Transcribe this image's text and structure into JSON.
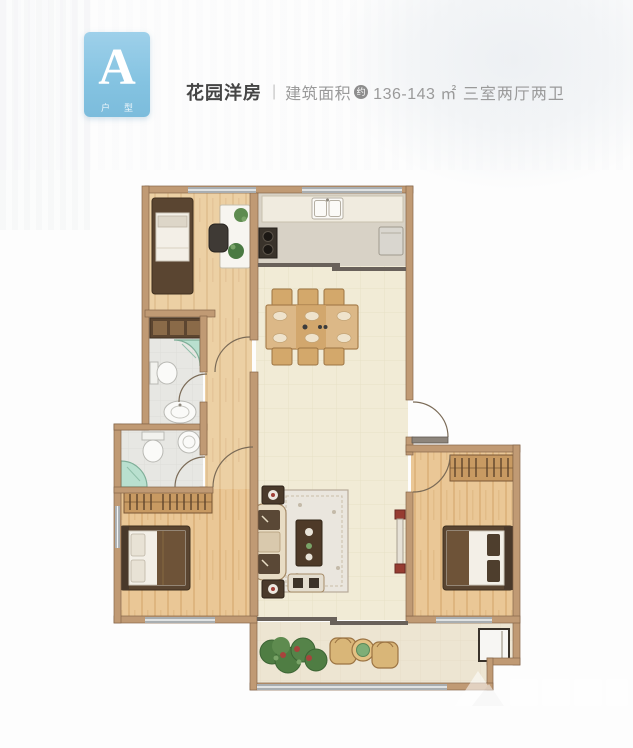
{
  "header": {
    "badge": {
      "letter": "A",
      "sublabel": "户型"
    },
    "title": "花园洋房",
    "divider": "|",
    "area_label": "建筑面积",
    "area_approx_badge": "约",
    "area_value": "136-143",
    "area_unit": "㎡",
    "layout_text": "三室两厅两卫"
  },
  "colors": {
    "badge_blue": "#84c3e1",
    "title_dark": "#454545",
    "title_gray": "#9a9a9a",
    "wall_tan": "#c09a74",
    "wood_floor": "#ecd0a4",
    "bedroom_floor": "#eac493",
    "kitchen_floor": "#d8d2c6",
    "living_floor": "#f1ebd6",
    "bath_floor": "#e7e7e3",
    "balcony_floor": "#ede5d2",
    "shower_green": "#b9e0cf",
    "dark_wood_furniture": "#5a4531",
    "window_gray": "#a9aeb1"
  }
}
